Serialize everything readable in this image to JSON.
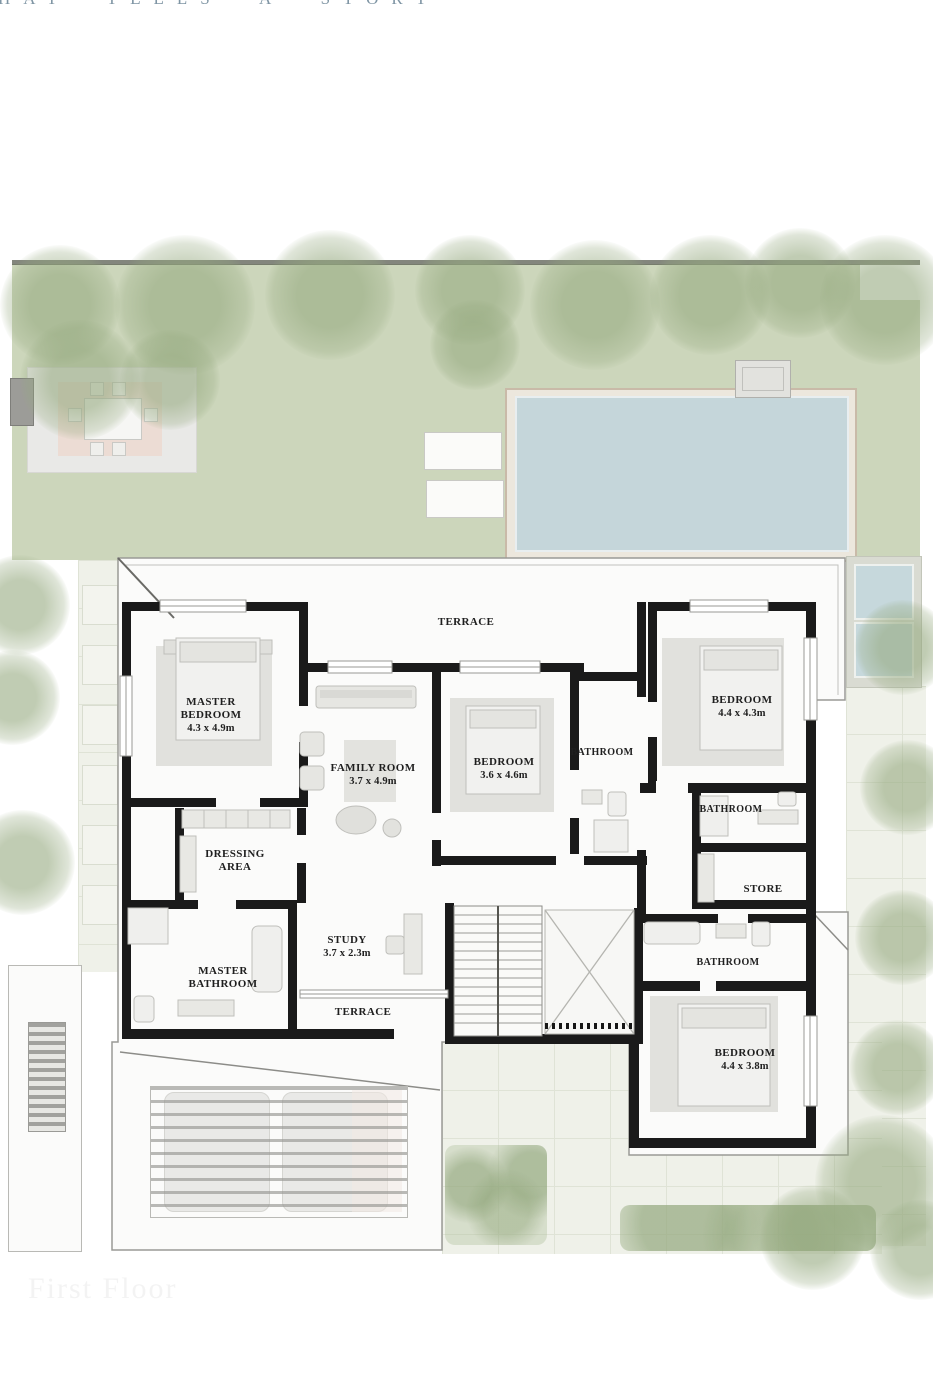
{
  "header": {
    "tagline_visible": "HAT TELLS A STORY"
  },
  "footer": {
    "faint_label": "First Floor"
  },
  "plan": {
    "type": "floor-plan",
    "rooms": [
      {
        "id": "terrace-top",
        "name": "TERRACE",
        "dims": ""
      },
      {
        "id": "master-bedroom",
        "name": "MASTER BEDROOM",
        "dims": "4.3 x 4.9m"
      },
      {
        "id": "family-room",
        "name": "FAMILY ROOM",
        "dims": "3.7 x 4.9m"
      },
      {
        "id": "bedroom-1",
        "name": "BEDROOM",
        "dims": "3.6 x 4.6m"
      },
      {
        "id": "bathroom-1",
        "name": "BATHROOM",
        "dims": ""
      },
      {
        "id": "bedroom-2",
        "name": "BEDROOM",
        "dims": "4.4 x 4.3m"
      },
      {
        "id": "bathroom-2",
        "name": "BATHROOM",
        "dims": ""
      },
      {
        "id": "store",
        "name": "STORE",
        "dims": ""
      },
      {
        "id": "dressing-area",
        "name": "DRESSING AREA",
        "dims": ""
      },
      {
        "id": "study",
        "name": "STUDY",
        "dims": "3.7 x 2.3m"
      },
      {
        "id": "master-bathroom",
        "name": "MASTER BATHROOM",
        "dims": ""
      },
      {
        "id": "terrace-bottom",
        "name": "TERRACE",
        "dims": ""
      },
      {
        "id": "bathroom-3",
        "name": "BATHROOM",
        "dims": ""
      },
      {
        "id": "bedroom-3",
        "name": "BEDROOM",
        "dims": "4.4 x 3.8m"
      }
    ],
    "colors": {
      "wall": "#1a1a1a",
      "lawn": "#ccd6bb",
      "pool_water": "#c5d6da",
      "pool_rim": "#c9baa8",
      "tree": "#96aa80",
      "label_text": "#1f1f1f",
      "tagline_text": "#7f95a4"
    }
  }
}
